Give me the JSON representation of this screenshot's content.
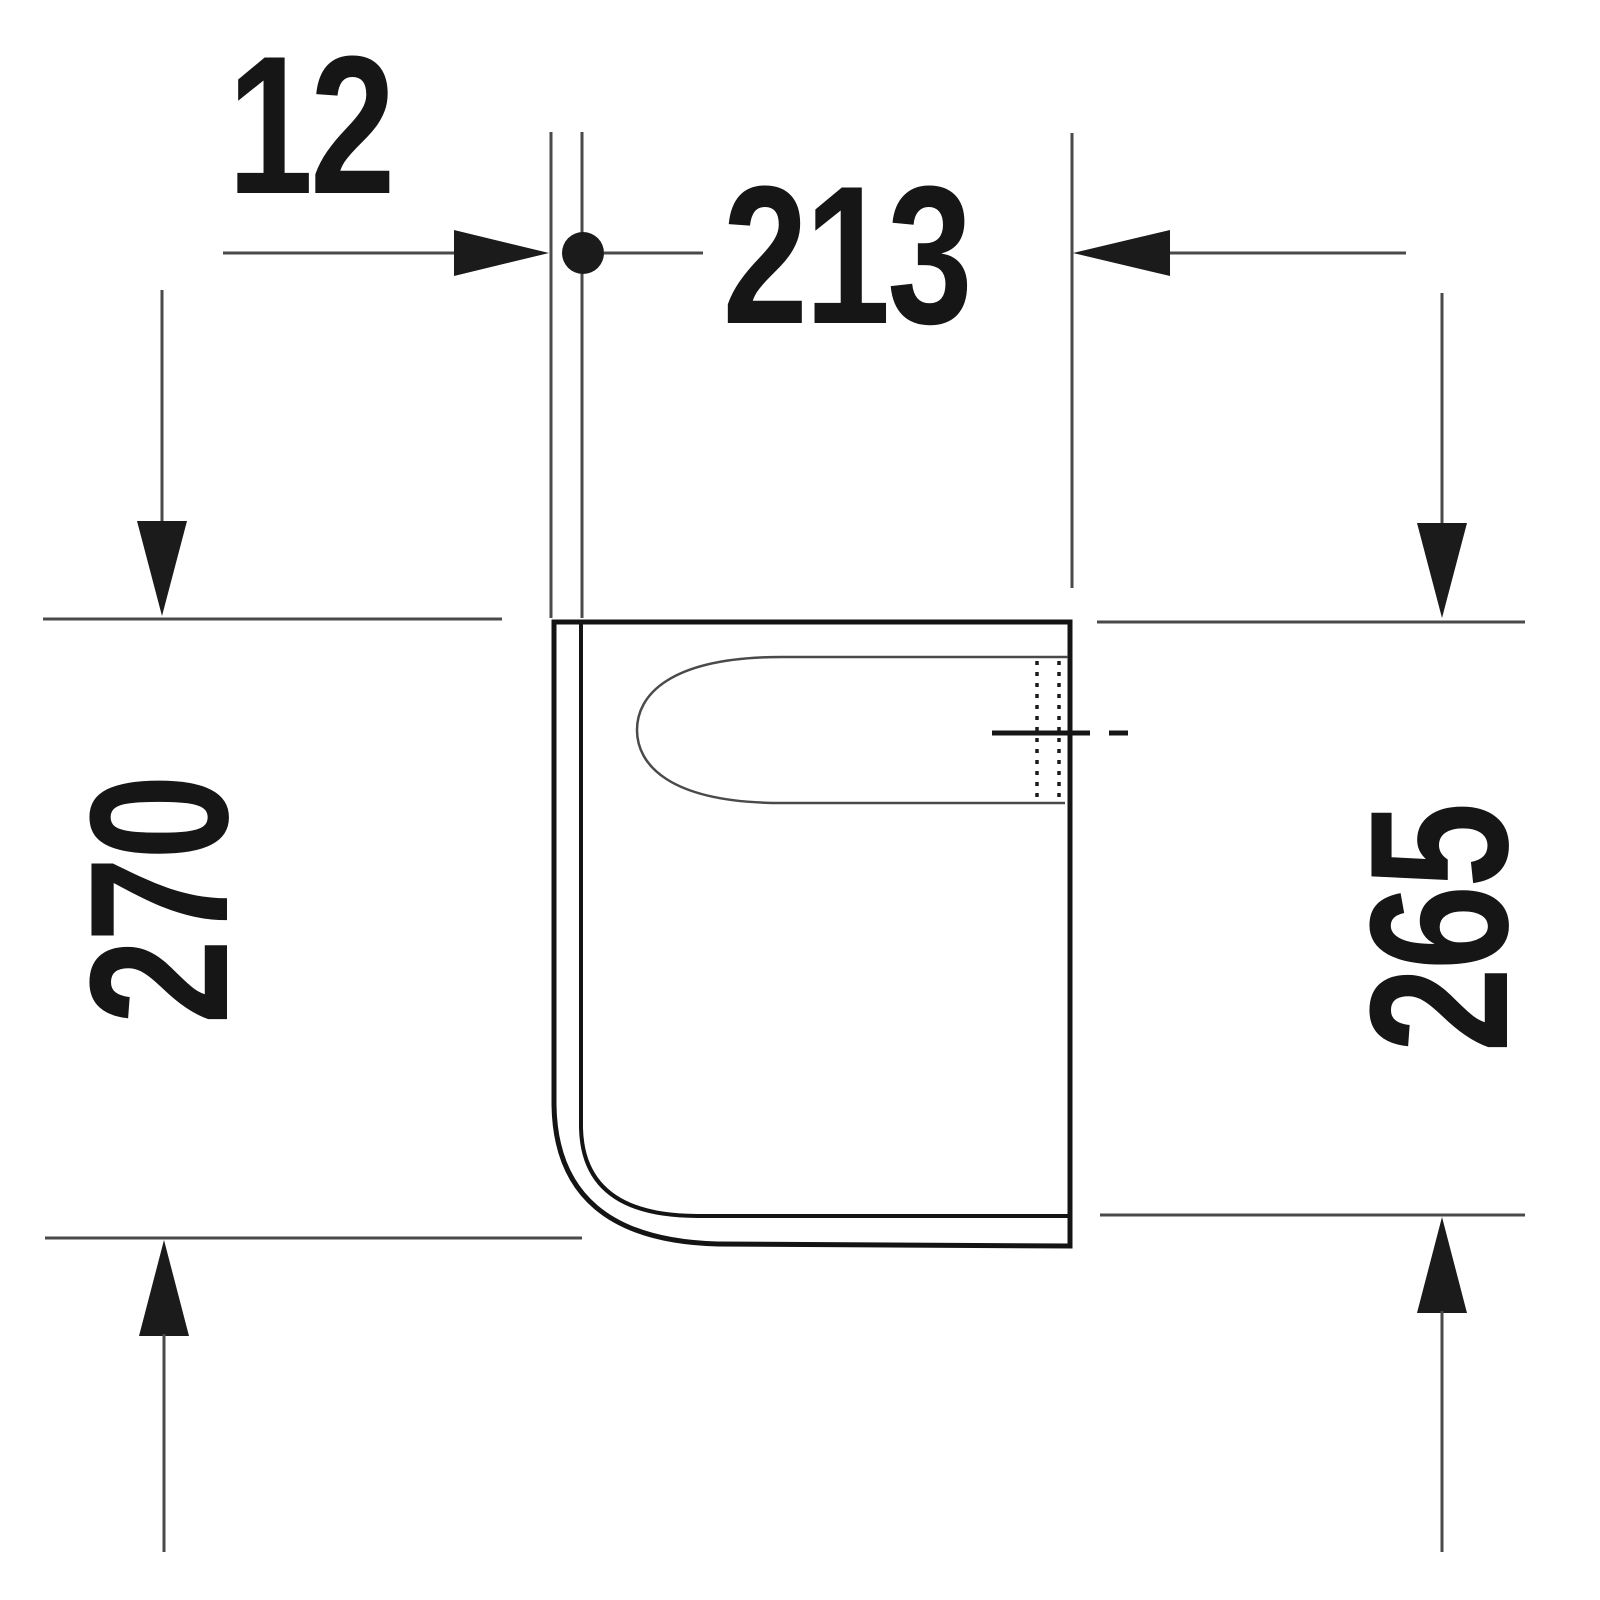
{
  "drawing": {
    "labels": {
      "wall_thickness": "12",
      "depth": "213",
      "overall_height": "270",
      "front_height": "265"
    },
    "colors": {
      "background": "#ffffff",
      "outline": "#141414",
      "dimension_lines": "#4a4a4a",
      "text": "#161616"
    }
  }
}
